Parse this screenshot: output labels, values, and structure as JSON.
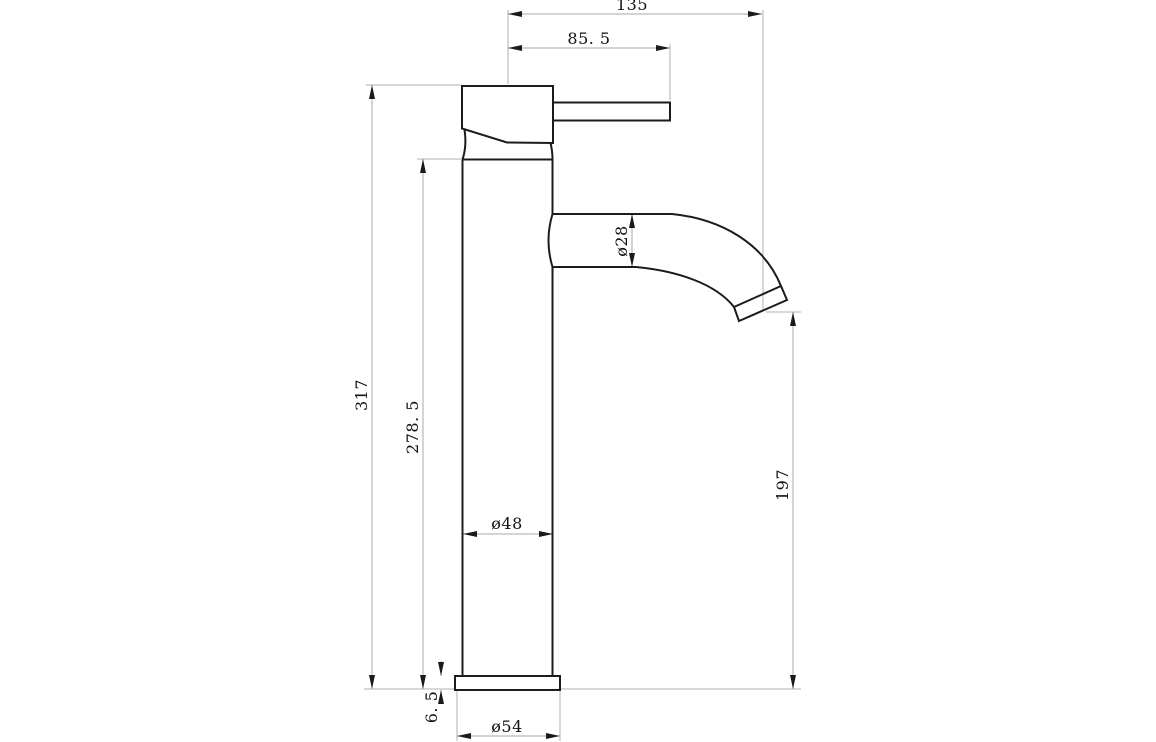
{
  "drawing": {
    "title": "tall-single-lever-basin-mixer-side-elevation",
    "units": "mm",
    "colors": {
      "outline": "#1c1c1c",
      "dimension_lines": "#a8a8a8",
      "text": "#121212",
      "background": "#ffffff"
    },
    "dims": {
      "d135": {
        "label": "135",
        "value": 135,
        "orientation": "horizontal",
        "measures": "overall-reach"
      },
      "d85_5": {
        "label": "85. 5",
        "value": 85.5,
        "orientation": "horizontal",
        "measures": "handle-reach"
      },
      "d317": {
        "label": "317",
        "value": 317,
        "orientation": "vertical",
        "measures": "overall-height"
      },
      "d278_5": {
        "label": "278. 5",
        "value": 278.5,
        "orientation": "vertical",
        "measures": "body-height"
      },
      "d28": {
        "label": "ø28",
        "value": 28,
        "orientation": "vertical",
        "measures": "spout-diameter"
      },
      "d197": {
        "label": "197",
        "value": 197,
        "orientation": "vertical",
        "measures": "spout-outlet-height"
      },
      "d48": {
        "label": "ø48",
        "value": 48,
        "orientation": "horizontal",
        "measures": "body-diameter"
      },
      "d6_5": {
        "label": "6. 5",
        "value": 6.5,
        "orientation": "vertical",
        "measures": "base-flange-height"
      },
      "d54": {
        "label": "ø54",
        "value": 54,
        "orientation": "horizontal",
        "measures": "base-diameter"
      }
    }
  }
}
